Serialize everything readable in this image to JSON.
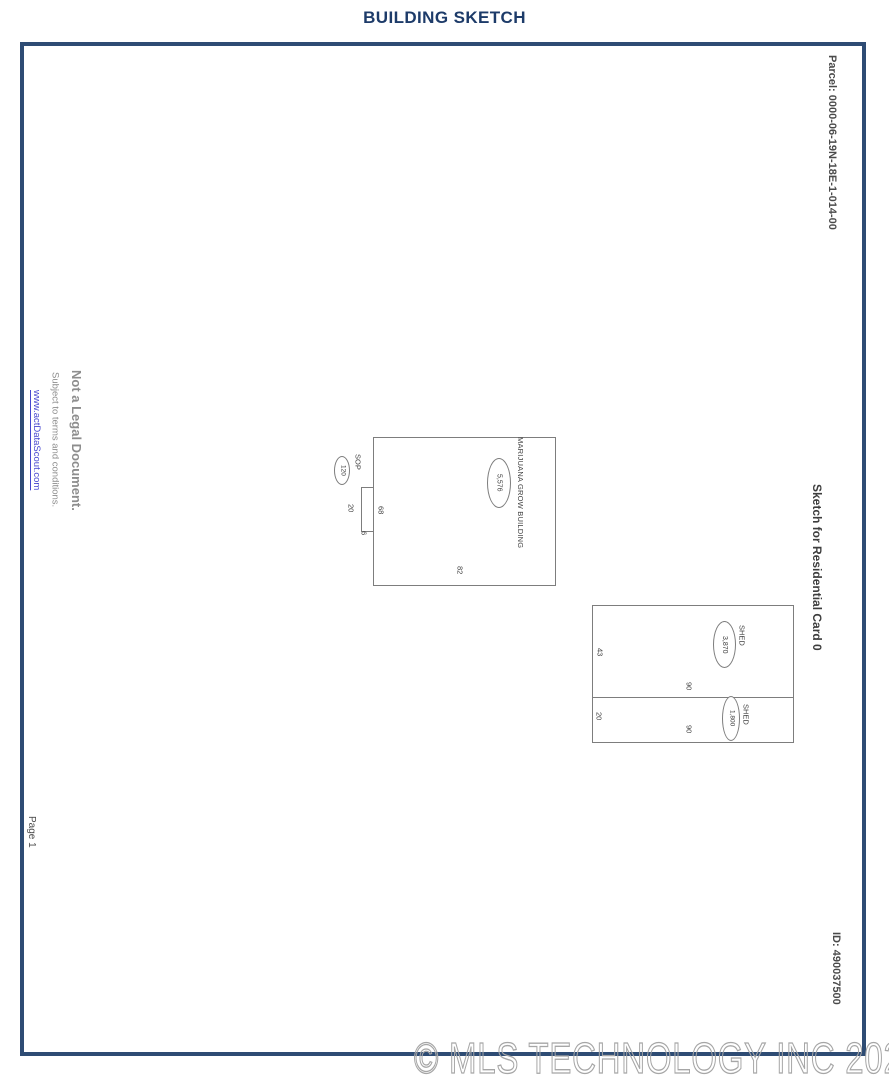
{
  "colors": {
    "navy": "#2e4c74",
    "title-navy": "#1d3b69",
    "gray-text": "#4a4a4a",
    "light-gray": "#8d8d8d",
    "link-blue": "#4646cf",
    "sketch-line": "#7d7d7d",
    "sketch-text": "#3f3f3f",
    "watermark-gray": "#a6a6a6"
  },
  "header": {
    "title": "BUILDING SKETCH"
  },
  "margins": {
    "parcel": "Parcel:  0000-06-19N-18E-1-014-00",
    "sketch_card_title": "Sketch for Residential Card 0",
    "record_id": "ID:  490037500",
    "page_number": "Page 1",
    "legal": {
      "line1": "Not a Legal Document.",
      "line2": "Subject to terms and conditions.",
      "link": "www.actDataScout.com"
    }
  },
  "sketch": {
    "grow_building": {
      "label": "MARIJUANA GROW BUILDING",
      "area": "5,576",
      "dim_bottom": "82",
      "dim_left": "68"
    },
    "sop": {
      "label": "SOP",
      "area": "120",
      "dim_left": "20",
      "dim_bottom": "6"
    },
    "shed_top": {
      "label": "SHED",
      "area": "3,870",
      "dim_left": "43",
      "dim_bottom": "90"
    },
    "shed_bottom": {
      "label": "SHED",
      "area": "1,800",
      "dim_left": "20",
      "dim_bottom": "90"
    }
  },
  "watermark": "© MLS TECHNOLOGY INC 2025"
}
